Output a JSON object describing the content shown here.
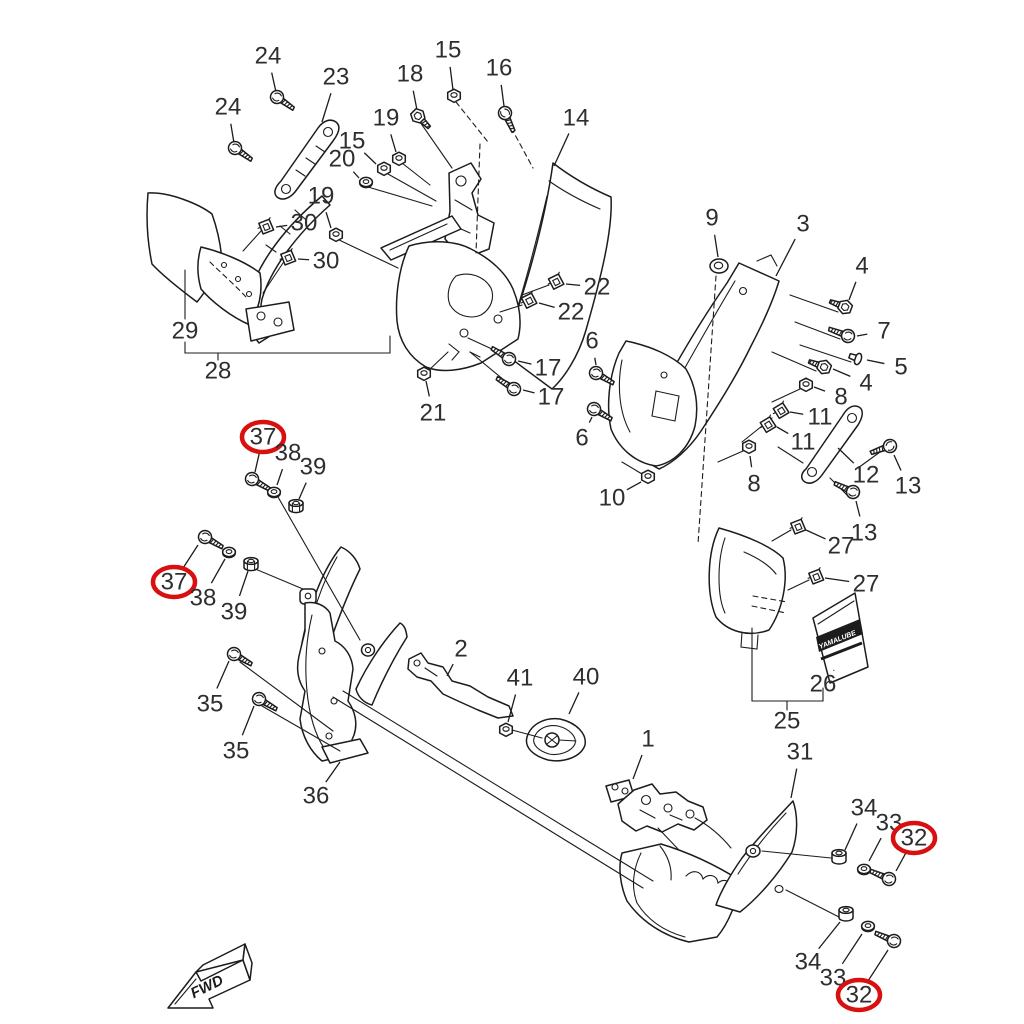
{
  "diagram": {
    "type": "exploded-parts-diagram",
    "subject": "motorcycle cowling assembly",
    "fwd_label": "FWD",
    "decal_label": "YAMALUBE",
    "colors": {
      "background": "#ffffff",
      "line": "#1c1c1c",
      "label": "#2e2e2e",
      "highlight": "#d81010"
    },
    "highlighted_parts": [
      "37",
      "32"
    ],
    "callouts": [
      {
        "text": "24",
        "x": 268,
        "y": 56,
        "lx": 276,
        "ly": 92
      },
      {
        "text": "24",
        "x": 228,
        "y": 107,
        "lx": 234,
        "ly": 143
      },
      {
        "text": "23",
        "x": 336,
        "y": 77,
        "lx": 322,
        "ly": 122
      },
      {
        "text": "18",
        "x": 410,
        "y": 74,
        "lx": 417,
        "ly": 110
      },
      {
        "text": "15",
        "x": 448,
        "y": 50,
        "lx": 453,
        "ly": 90
      },
      {
        "text": "16",
        "x": 499,
        "y": 68,
        "lx": 504,
        "ly": 106
      },
      {
        "text": "19",
        "x": 386,
        "y": 118,
        "lx": 396,
        "ly": 152
      },
      {
        "text": "15",
        "x": 352,
        "y": 141,
        "lx": 376,
        "ly": 164
      },
      {
        "text": "20",
        "x": 342,
        "y": 159,
        "lx": 359,
        "ly": 178
      },
      {
        "text": "19",
        "x": 321,
        "y": 196,
        "lx": 331,
        "ly": 228
      },
      {
        "text": "30",
        "x": 304,
        "y": 223,
        "lx": 276,
        "ly": 227
      },
      {
        "text": "30",
        "x": 326,
        "y": 261,
        "lx": 298,
        "ly": 259
      },
      {
        "text": "14",
        "x": 576,
        "y": 118,
        "lx": 554,
        "ly": 166
      },
      {
        "text": "29",
        "x": 185,
        "y": 331
      },
      {
        "text": "28",
        "x": 218,
        "y": 371
      },
      {
        "text": "21",
        "x": 433,
        "y": 413,
        "lx": 426,
        "ly": 381
      },
      {
        "text": "17",
        "x": 548,
        "y": 368,
        "lx": 518,
        "ly": 361
      },
      {
        "text": "17",
        "x": 551,
        "y": 397,
        "lx": 523,
        "ly": 390
      },
      {
        "text": "22",
        "x": 597,
        "y": 287,
        "lx": 566,
        "ly": 284
      },
      {
        "text": "22",
        "x": 571,
        "y": 312,
        "lx": 539,
        "ly": 303
      },
      {
        "text": "9",
        "x": 712,
        "y": 218,
        "lx": 718,
        "ly": 257
      },
      {
        "text": "3",
        "x": 803,
        "y": 224,
        "lx": 776,
        "ly": 276
      },
      {
        "text": "4",
        "x": 862,
        "y": 266,
        "lx": 849,
        "ly": 300
      },
      {
        "text": "7",
        "x": 884,
        "y": 331,
        "lx": 857,
        "ly": 336
      },
      {
        "text": "5",
        "x": 901,
        "y": 367,
        "lx": 867,
        "ly": 360
      },
      {
        "text": "4",
        "x": 866,
        "y": 383,
        "lx": 833,
        "ly": 369
      },
      {
        "text": "8",
        "x": 841,
        "y": 397,
        "lx": 814,
        "ly": 387
      },
      {
        "text": "11",
        "x": 820,
        "y": 417,
        "lx": 790,
        "ly": 412
      },
      {
        "text": "11",
        "x": 803,
        "y": 442,
        "lx": 777,
        "ly": 427
      },
      {
        "text": "6",
        "x": 592,
        "y": 341,
        "lx": 596,
        "ly": 365
      },
      {
        "text": "6",
        "x": 582,
        "y": 438,
        "lx": 592,
        "ly": 417
      },
      {
        "text": "8",
        "x": 754,
        "y": 484,
        "lx": 750,
        "ly": 456
      },
      {
        "text": "12",
        "x": 866,
        "y": 475,
        "lx": 838,
        "ly": 448
      },
      {
        "text": "13",
        "x": 908,
        "y": 486,
        "lx": 894,
        "ly": 455
      },
      {
        "text": "13",
        "x": 864,
        "y": 533,
        "lx": 856,
        "ly": 501
      },
      {
        "text": "10",
        "x": 612,
        "y": 498,
        "lx": 641,
        "ly": 482
      },
      {
        "text": "27",
        "x": 841,
        "y": 546,
        "lx": 806,
        "ly": 530
      },
      {
        "text": "27",
        "x": 866,
        "y": 584,
        "lx": 825,
        "ly": 578
      },
      {
        "text": "26",
        "x": 823,
        "y": 684,
        "lx": 834,
        "ly": 670
      },
      {
        "text": "25",
        "x": 787,
        "y": 721
      },
      {
        "text": "37",
        "x": 263,
        "y": 437,
        "circled": true,
        "lx": 255,
        "ly": 472
      },
      {
        "text": "38",
        "x": 288,
        "y": 453,
        "lx": 277,
        "ly": 485
      },
      {
        "text": "39",
        "x": 313,
        "y": 467,
        "lx": 299,
        "ly": 499
      },
      {
        "text": "37",
        "x": 174,
        "y": 582,
        "circled": true,
        "lx": 198,
        "ly": 545
      },
      {
        "text": "38",
        "x": 203,
        "y": 598,
        "lx": 225,
        "ly": 559
      },
      {
        "text": "39",
        "x": 234,
        "y": 612,
        "lx": 248,
        "ly": 571
      },
      {
        "text": "35",
        "x": 210,
        "y": 704,
        "lx": 229,
        "ly": 661
      },
      {
        "text": "35",
        "x": 236,
        "y": 751,
        "lx": 254,
        "ly": 706
      },
      {
        "text": "36",
        "x": 316,
        "y": 796,
        "lx": 340,
        "ly": 762
      },
      {
        "text": "2",
        "x": 461,
        "y": 649,
        "lx": 447,
        "ly": 676
      },
      {
        "text": "41",
        "x": 520,
        "y": 678,
        "lx": 508,
        "ly": 722
      },
      {
        "text": "40",
        "x": 586,
        "y": 677,
        "lx": 569,
        "ly": 714
      },
      {
        "text": "1",
        "x": 648,
        "y": 739,
        "lx": 633,
        "ly": 779
      },
      {
        "text": "31",
        "x": 800,
        "y": 752,
        "lx": 791,
        "ly": 798
      },
      {
        "text": "34",
        "x": 864,
        "y": 808,
        "lx": 845,
        "ly": 850
      },
      {
        "text": "33",
        "x": 889,
        "y": 823,
        "lx": 869,
        "ly": 861
      },
      {
        "text": "32",
        "x": 914,
        "y": 838,
        "circled": true,
        "lx": 896,
        "ly": 871
      },
      {
        "text": "34",
        "x": 808,
        "y": 962,
        "lx": 840,
        "ly": 922
      },
      {
        "text": "33",
        "x": 833,
        "y": 978,
        "lx": 862,
        "ly": 934
      },
      {
        "text": "32",
        "x": 859,
        "y": 995,
        "circled": true,
        "lx": 888,
        "ly": 950
      }
    ],
    "fasteners": [
      {
        "type": "screw",
        "x": 277,
        "y": 97,
        "rot": 35
      },
      {
        "type": "screw",
        "x": 235,
        "y": 148,
        "rot": 35
      },
      {
        "type": "screw",
        "x": 505,
        "y": 113,
        "rot": 65
      },
      {
        "type": "screw",
        "x": 509,
        "y": 359,
        "rot": 212
      },
      {
        "type": "screw",
        "x": 514,
        "y": 389,
        "rot": 212
      },
      {
        "type": "screw",
        "x": 596,
        "y": 373,
        "rot": 30
      },
      {
        "type": "screw",
        "x": 594,
        "y": 409,
        "rot": 30
      },
      {
        "type": "screw",
        "x": 848,
        "y": 336,
        "rot": 200
      },
      {
        "type": "screw",
        "x": 890,
        "y": 446,
        "rot": 160
      },
      {
        "type": "screw",
        "x": 853,
        "y": 492,
        "rot": 205
      },
      {
        "type": "screw",
        "x": 252,
        "y": 479,
        "rot": 30
      },
      {
        "type": "screw",
        "x": 205,
        "y": 537,
        "rot": 30
      },
      {
        "type": "screw",
        "x": 234,
        "y": 654,
        "rot": 30
      },
      {
        "type": "screw",
        "x": 259,
        "y": 699,
        "rot": 30
      },
      {
        "type": "screw",
        "x": 889,
        "y": 879,
        "rot": 203
      },
      {
        "type": "screw",
        "x": 894,
        "y": 941,
        "rot": 203
      },
      {
        "type": "bolt",
        "x": 418,
        "y": 116,
        "rot": 45
      },
      {
        "type": "bolt",
        "x": 845,
        "y": 307,
        "rot": 200
      },
      {
        "type": "bolt",
        "x": 824,
        "y": 367,
        "rot": 200
      },
      {
        "type": "rivet",
        "x": 858,
        "y": 359,
        "rot": 200
      },
      {
        "type": "nut",
        "x": 454,
        "y": 96,
        "rot": 0
      },
      {
        "type": "nut",
        "x": 384,
        "y": 169,
        "rot": 0
      },
      {
        "type": "nut",
        "x": 399,
        "y": 159,
        "rot": 0
      },
      {
        "type": "nut",
        "x": 336,
        "y": 235,
        "rot": 0
      },
      {
        "type": "nut",
        "x": 424,
        "y": 374,
        "rot": 0
      },
      {
        "type": "nut",
        "x": 806,
        "y": 385,
        "rot": 0
      },
      {
        "type": "nut",
        "x": 749,
        "y": 447,
        "rot": 0
      },
      {
        "type": "nut",
        "x": 648,
        "y": 477,
        "rot": 0
      },
      {
        "type": "nut",
        "x": 506,
        "y": 730,
        "rot": 0
      },
      {
        "type": "washer",
        "x": 366,
        "y": 182,
        "rot": 0
      },
      {
        "type": "washer",
        "x": 274,
        "y": 492,
        "rot": 0
      },
      {
        "type": "washer",
        "x": 229,
        "y": 552,
        "rot": 0
      },
      {
        "type": "washer",
        "x": 864,
        "y": 869,
        "rot": 0
      },
      {
        "type": "washer",
        "x": 868,
        "y": 926,
        "rot": 0
      },
      {
        "type": "flangenut",
        "x": 296,
        "y": 506,
        "rot": 0
      },
      {
        "type": "flangenut",
        "x": 251,
        "y": 564,
        "rot": 0
      },
      {
        "type": "clip",
        "x": 266,
        "y": 227,
        "rot": -15
      },
      {
        "type": "clip",
        "x": 288,
        "y": 258,
        "rot": -15
      },
      {
        "type": "clip",
        "x": 556,
        "y": 282,
        "rot": -20
      },
      {
        "type": "clip",
        "x": 529,
        "y": 301,
        "rot": -20
      },
      {
        "type": "clip",
        "x": 781,
        "y": 411,
        "rot": -25
      },
      {
        "type": "clip",
        "x": 768,
        "y": 425,
        "rot": -25
      },
      {
        "type": "clip",
        "x": 798,
        "y": 527,
        "rot": -15
      },
      {
        "type": "clip",
        "x": 816,
        "y": 577,
        "rot": -15
      },
      {
        "type": "grommet",
        "x": 719,
        "y": 266,
        "rot": 0
      },
      {
        "type": "collar",
        "x": 839,
        "y": 857,
        "rot": 0
      },
      {
        "type": "collar",
        "x": 846,
        "y": 914,
        "rot": 0
      }
    ]
  }
}
